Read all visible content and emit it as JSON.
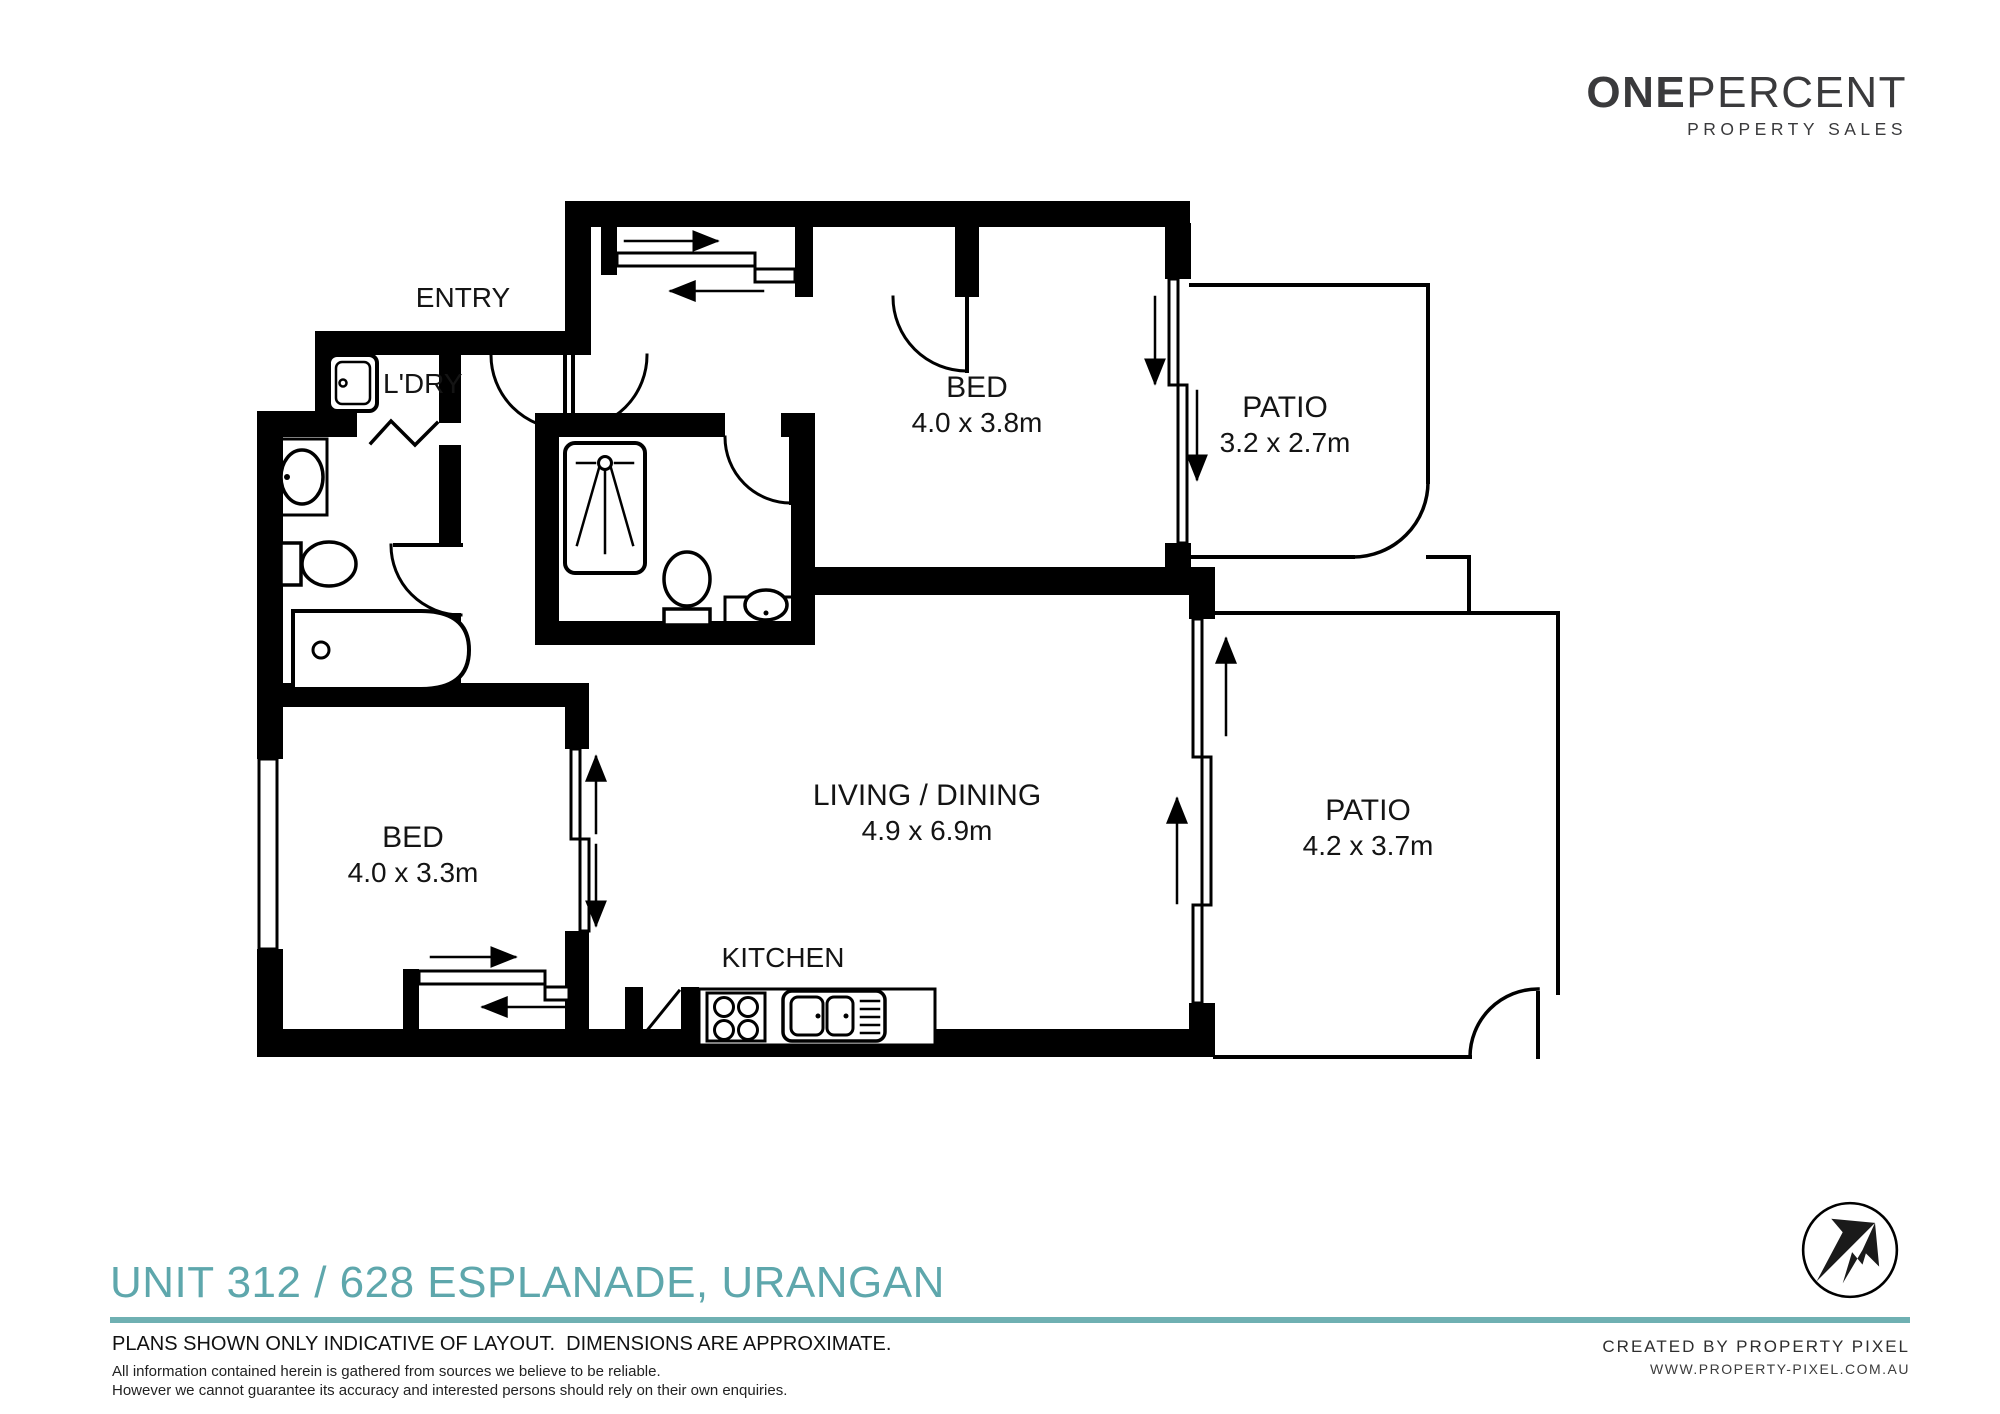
{
  "brand": {
    "name_bold": "ONE",
    "name_light": "PERCENT",
    "tagline": "PROPERTY SALES"
  },
  "floorplan": {
    "rooms": [
      {
        "label": "ENTRY",
        "dimensions": ""
      },
      {
        "label": "L'DRY",
        "dimensions": ""
      },
      {
        "label": "BED",
        "dimensions": "4.0 x 3.8m"
      },
      {
        "label": "PATIO",
        "dimensions": "3.2 x 2.7m"
      },
      {
        "label": "BED",
        "dimensions": "4.0 x 3.3m"
      },
      {
        "label": "LIVING / DINING",
        "dimensions": "4.9 x 6.9m"
      },
      {
        "label": "KITCHEN",
        "dimensions": ""
      },
      {
        "label": "PATIO",
        "dimensions": "4.2 x 3.7m"
      }
    ],
    "fixtures": [
      "washing-machine",
      "basin",
      "toilet",
      "bathtub",
      "shower",
      "vanity-basin",
      "cooktop",
      "double-sink",
      "sliding-wardrobe",
      "sliding-door",
      "hinged-door",
      "window"
    ]
  },
  "footer": {
    "title": "UNIT 312 / 628 ESPLANADE, URANGAN",
    "disclaimer_primary": "PLANS SHOWN ONLY INDICATIVE OF LAYOUT.  DIMENSIONS ARE APPROXIMATE.",
    "disclaimer_line1": "All information contained herein is gathered from sources we believe to be reliable.",
    "disclaimer_line2": "However we cannot guarantee its accuracy and interested persons should rely on their own enquiries.",
    "credit_line1": "CREATED BY PROPERTY PIXEL",
    "credit_line2": "WWW.PROPERTY-PIXEL.COM.AU"
  },
  "colors": {
    "accent_teal": "#6fb0b2",
    "title_teal": "#5ea7ac",
    "wall_black": "#000000",
    "logo_charcoal": "#3a3a3c"
  }
}
